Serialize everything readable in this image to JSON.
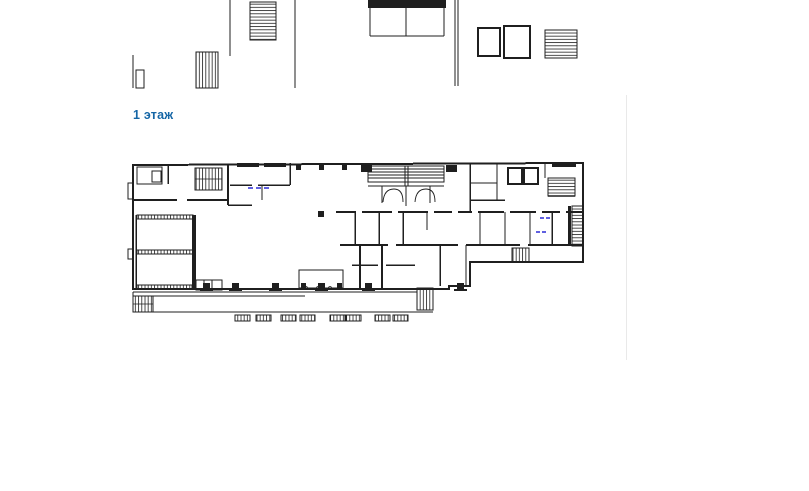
{
  "page": {
    "background": "#ffffff"
  },
  "heading": {
    "label": "1 этаж"
  },
  "floor_plan": {
    "caption": "1 этаж",
    "kind": "architectural floor plan drawing"
  },
  "colors": {
    "ink": "#1f1f1f",
    "blue": "#1566a6",
    "accent": "#2b2bd6",
    "divider": "#e9e9e9",
    "bg": "#ffffff"
  }
}
